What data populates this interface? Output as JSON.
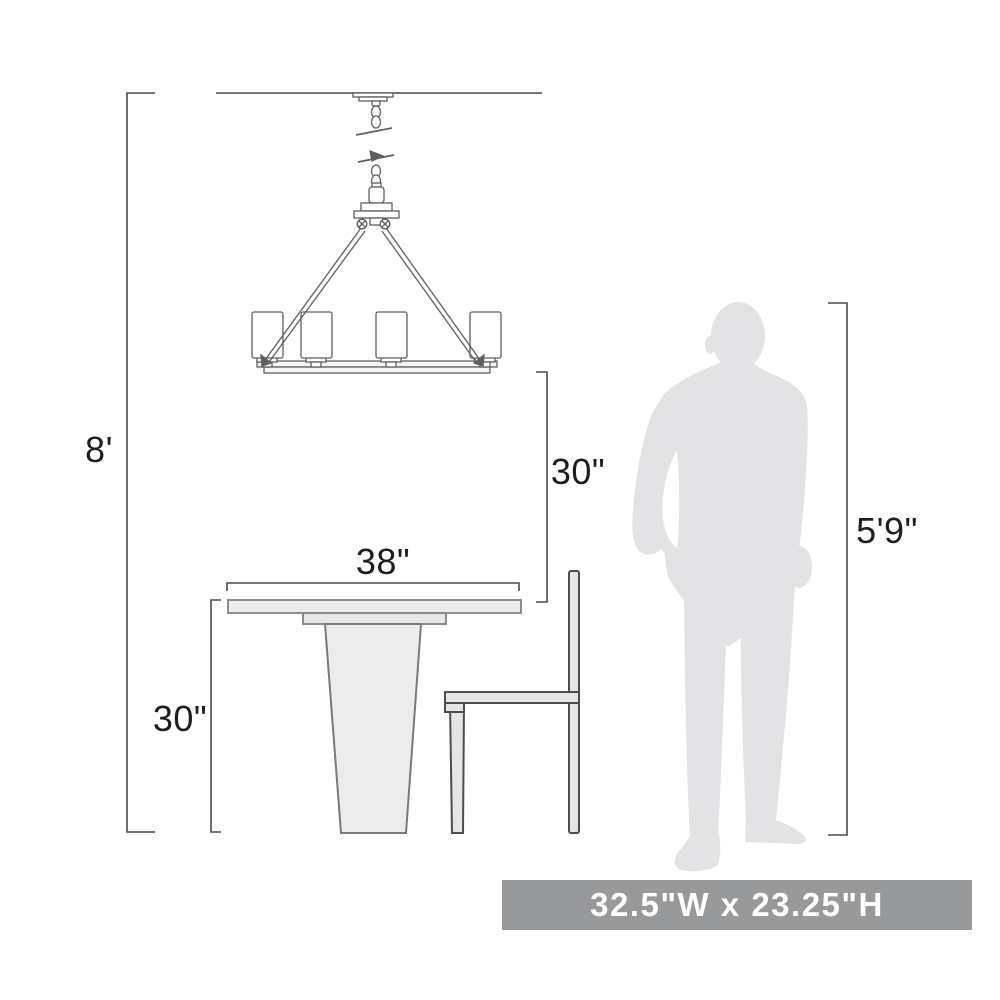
{
  "labels": {
    "ceiling_height": "8'",
    "fixture_to_table": "30\"",
    "table_width": "38\"",
    "table_height": "30\"",
    "person_height": "5'9\""
  },
  "banner": {
    "text": "32.5\"W x 23.25\"H"
  },
  "figures": [
    "chandelier",
    "dining-table",
    "chair",
    "person-silhouette"
  ],
  "colors": {
    "line": "#4a4a4a",
    "drawing_line": "#5f5f5f",
    "furniture_fill": "#ececed",
    "silhouette_fill": "#e3e3e5",
    "banner_background": "#98999b",
    "banner_text": "#ffffff",
    "background": "#ffffff"
  }
}
